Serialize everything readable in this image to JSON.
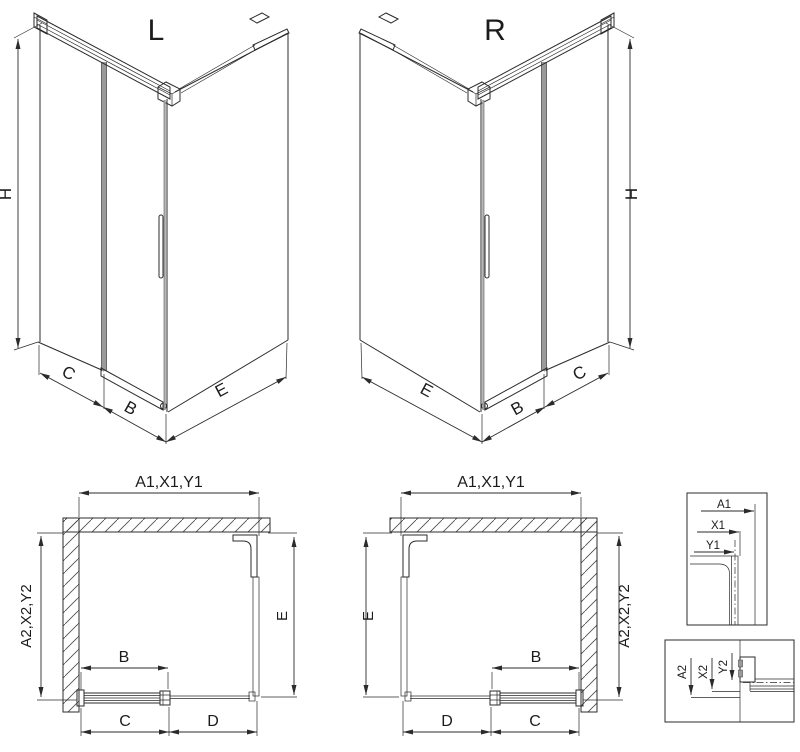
{
  "figure": {
    "type": "shower-enclosure-technical-drawing",
    "background_color": "#ffffff",
    "line_color": "#2b2b2b",
    "glass_color": "#9a9a9a"
  },
  "views": {
    "iso_left": {
      "title": "L",
      "dims": {
        "height": "H",
        "wall_panel": "C",
        "door": "B",
        "side_panel": "E"
      }
    },
    "iso_right": {
      "title": "R",
      "dims": {
        "height": "H",
        "wall_panel": "C",
        "door": "B",
        "side_panel": "E"
      }
    },
    "plan_left": {
      "dims": {
        "top": "A1,X1,Y1",
        "side": "A2,X2,Y2",
        "return_panel": "E",
        "door": "B",
        "door_zone": "C",
        "fixed_zone": "D"
      }
    },
    "plan_right": {
      "dims": {
        "top": "A1,X1,Y1",
        "side": "A2,X2,Y2",
        "return_panel": "E",
        "door": "B",
        "door_zone": "C",
        "fixed_zone": "D"
      }
    },
    "detail_top": {
      "labels": [
        "A1",
        "X1",
        "Y1"
      ]
    },
    "detail_bottom": {
      "labels": [
        "A2",
        "X2",
        "Y2"
      ]
    }
  }
}
